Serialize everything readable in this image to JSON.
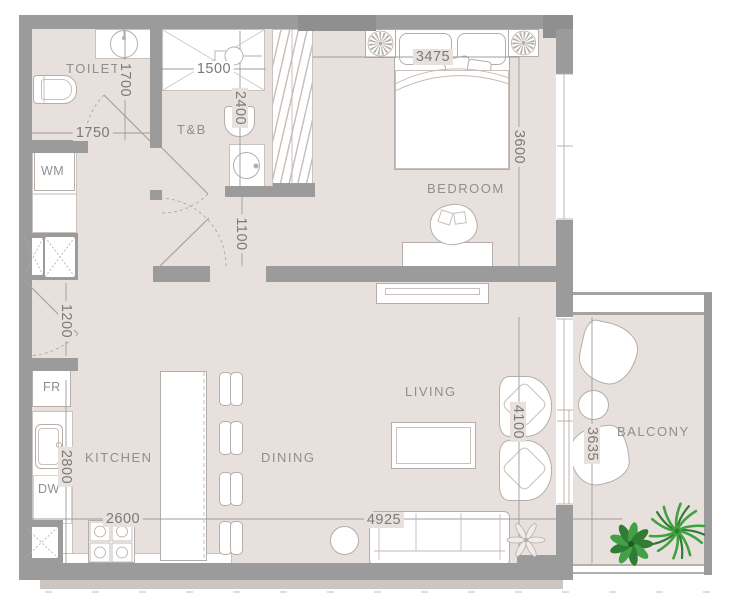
{
  "rooms": {
    "toilet": {
      "label": "TOILET"
    },
    "tb": {
      "label": "T&B"
    },
    "bedroom": {
      "label": "BEDROOM"
    },
    "kitchen": {
      "label": "KITCHEN"
    },
    "dining": {
      "label": "DINING"
    },
    "living": {
      "label": "LIVING"
    },
    "balcony": {
      "label": "BALCONY"
    }
  },
  "appliances": {
    "washing_machine": {
      "label": "WM"
    },
    "fridge": {
      "label": "FR"
    },
    "dishwasher": {
      "label": "DW"
    }
  },
  "dimensions_mm": {
    "toilet_width": "1750",
    "toilet_depth": "1700",
    "shower_width": "1500",
    "tb_depth": "2400",
    "hall_width": "1100",
    "entry_width": "1200",
    "bed_wall_width": "3475",
    "bedroom_depth": "3600",
    "kitchen_depth": "2800",
    "kitchen_width": "2600",
    "living_dining_width": "4925",
    "living_depth": "4100",
    "balcony_depth": "3635"
  },
  "colors": {
    "floor": "#e8e0dc",
    "wall": "#9b9b9b",
    "wall_dark": "#8f8f8f",
    "line": "#b5ada9",
    "line_light": "#c9c1bd",
    "label": "#8f8f8f",
    "dim": "#7a7a7a"
  }
}
